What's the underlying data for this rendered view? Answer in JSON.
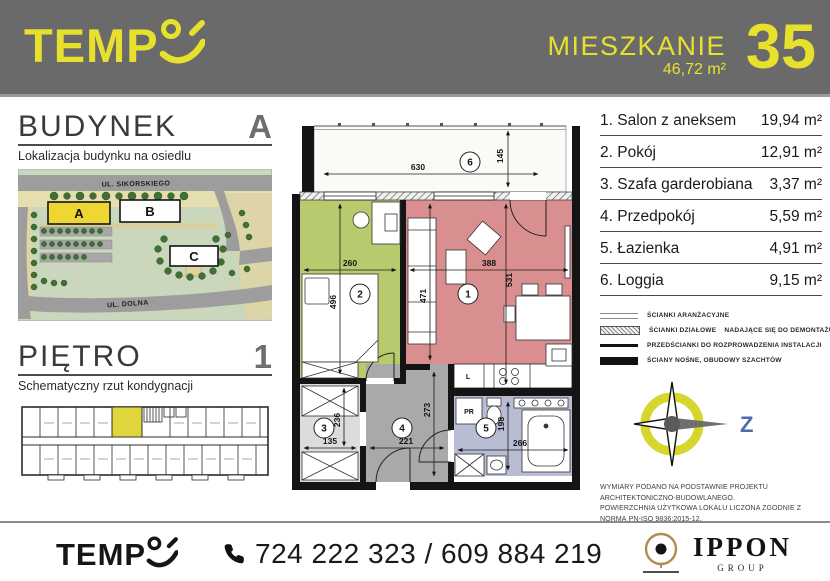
{
  "header": {
    "brand": "TEMP",
    "unit_label": "MIESZKANIE",
    "unit_area": "46,72 m²",
    "unit_number": "35"
  },
  "building_section": {
    "title": "BUDYNEK",
    "value": "A",
    "subtitle": "Lokalizacja budynku na osiedlu",
    "map": {
      "street_top": "UL. SIKORSKIEGO",
      "street_bottom": "UL. DOLNA",
      "building_a": "A",
      "building_b": "B",
      "building_c": "C"
    }
  },
  "floor_section": {
    "title": "PIĘTRO",
    "value": "1",
    "subtitle": "Schematyczny rzut kondygnacji"
  },
  "rooms": [
    {
      "num": "1",
      "label": "1. Salon z aneksem",
      "area": "19,94 m²"
    },
    {
      "num": "2",
      "label": "2. Pokój",
      "area": "12,91 m²"
    },
    {
      "num": "3",
      "label": "3. Szafa garderobiana",
      "area": "3,37 m²"
    },
    {
      "num": "4",
      "label": "4. Przedpokój",
      "area": "5,59 m²"
    },
    {
      "num": "5",
      "label": "5. Łazienka",
      "area": "4,91 m²"
    },
    {
      "num": "6",
      "label": "6. Loggia",
      "area": "9,15 m²"
    }
  ],
  "plan": {
    "dims": {
      "loggia_w": "630",
      "loggia_d": "145",
      "room2_w": "260",
      "room2_h": "496",
      "salon_w": "388",
      "salon_h": "531",
      "salon_h2": "471",
      "wardrobe_w": "135",
      "wardrobe_h": "236",
      "hall_w": "221",
      "hall_h": "273",
      "bath_w": "266",
      "bath_h": "198"
    },
    "labels": {
      "fridge": "L",
      "washer": "PR"
    }
  },
  "legend": {
    "items": [
      {
        "label": "ŚCIANKI ARANŻACYJNE"
      },
      {
        "label": "ŚCIANKI DZIAŁOWE    NADAJĄCE SIĘ DO DEMONTAŻU"
      },
      {
        "label": "PRZEDŚCIANKI DO ROZPROWADZENIA INSTALACJI"
      },
      {
        "label": "ŚCIANY NOŚNE, OBUDOWY SZACHTÓW"
      }
    ]
  },
  "compass": {
    "west_label": "Z"
  },
  "disclaimer": {
    "line1": "WYMIARY PODANO NA PODSTAWNIE PROJEKTU ARCHITEKTONICZNO-BUDOWLANEGO.",
    "line2": "POWIERZCHNIA UŻYTKOWA LOKALU LICZONA ZGODNIE Z NORMĄ PN-ISO 9836:2015-12."
  },
  "footer": {
    "brand": "TEMP",
    "phones": "724 222 323 / 609 884 219",
    "partner_name": "IPPON",
    "partner_sub": "GROUP"
  },
  "colors": {
    "accent_yellow": "#e7e12e",
    "header_bg": "#6b6a6a",
    "loggia": "#fbfaf6",
    "room_salon": "#d98f8f",
    "room_pokoj": "#b7ca6d",
    "room_szafa": "#dcdcdc",
    "room_przedpokoj": "#a9a9a9",
    "room_lazienka": "#b9bdd4",
    "building_a_fill": "#eed733",
    "schematic_unit_fill": "#e0d53a"
  }
}
